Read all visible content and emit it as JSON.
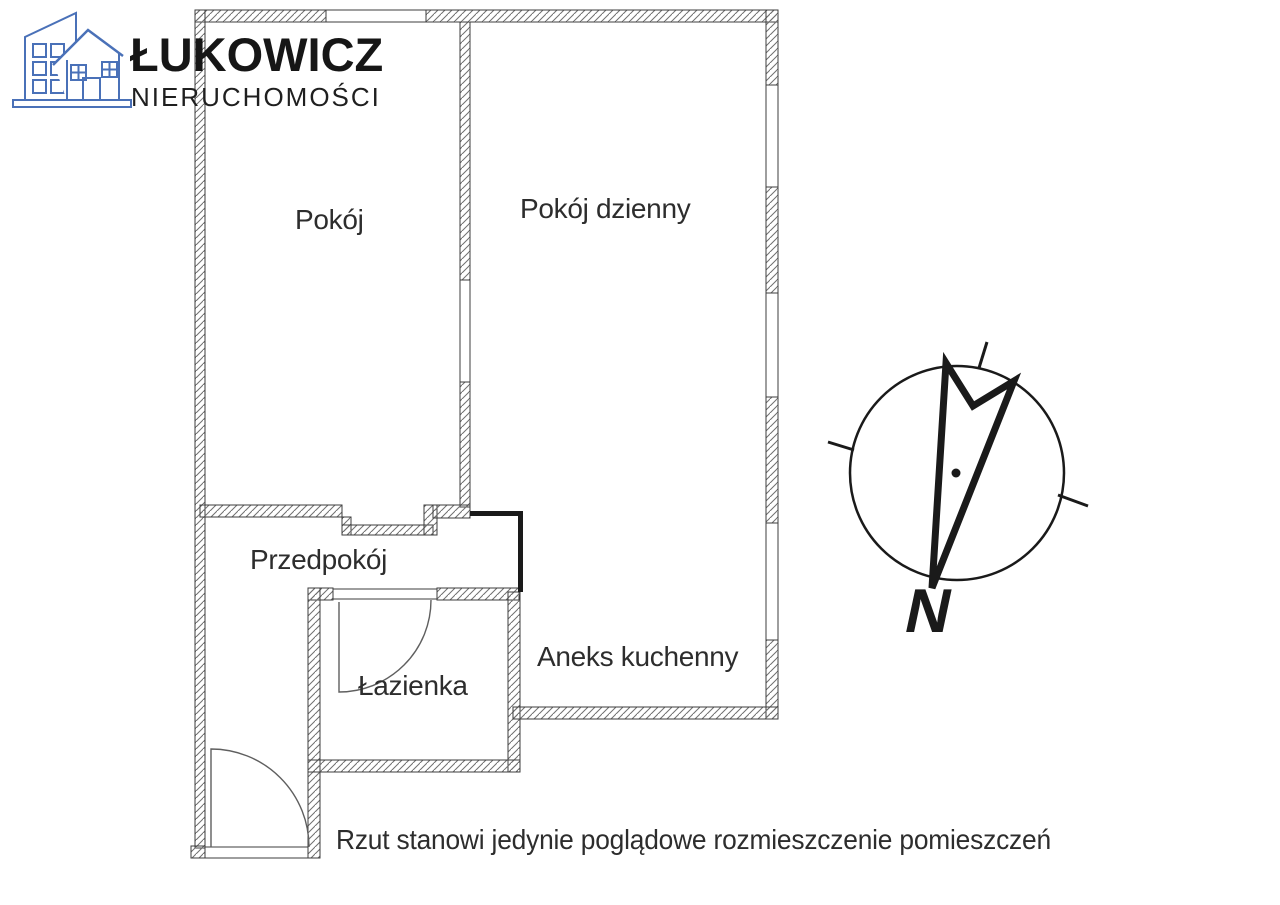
{
  "page": {
    "background": "#ffffff"
  },
  "branding": {
    "name": "ŁUKOWICZ",
    "subtitle": "NIERUCHOMOŚCI",
    "logo_color": "#4a71b8"
  },
  "floor_plan": {
    "rooms": [
      {
        "id": "pokoj",
        "label": "Pokój"
      },
      {
        "id": "pokoj-dzienny",
        "label": "Pokój dzienny"
      },
      {
        "id": "przedpokoj",
        "label": "Przedpokój"
      },
      {
        "id": "lazienka",
        "label": "Łazienka"
      },
      {
        "id": "aneks-kuchenny",
        "label": "Aneks kuchenny"
      }
    ],
    "disclaimer": "Rzut stanowi jedynie poglądowe rozmieszczenie pomieszczeń",
    "colors": {
      "wall_outline": "#3c3c3c",
      "wall_hatch": "#6f6f6f",
      "partition": "#1a1a1a",
      "door_arc": "#5f5f5f"
    }
  },
  "compass": {
    "north_label": "N"
  }
}
